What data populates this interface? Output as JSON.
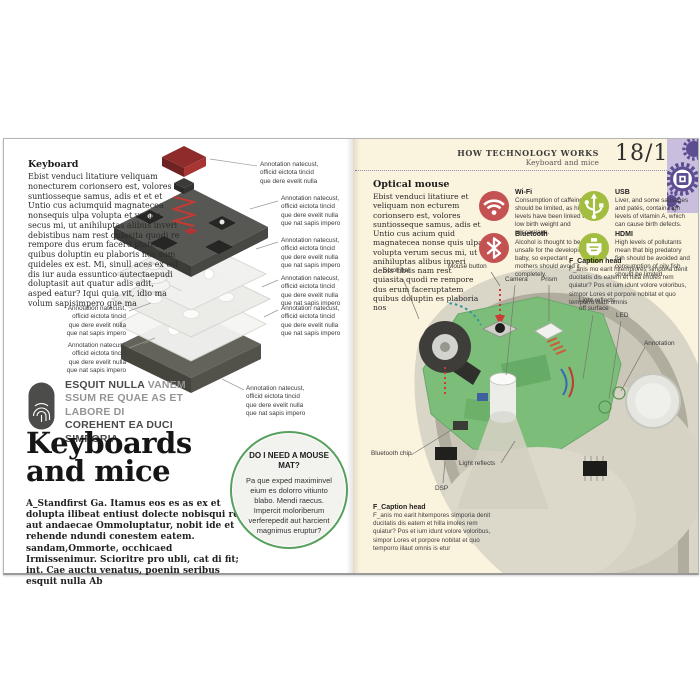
{
  "colors": {
    "right_page_bg": "#faf3dd",
    "feature_red": "#c45252",
    "feature_green": "#a2bd3f",
    "qa_circle_green": "#57a05e",
    "badge_purple": "#5d4d91",
    "badge_bg": "#c9bede",
    "pcb_green": "#7cbe79",
    "arrow_red": "#cc3b35",
    "arrow_teal": "#2e98a0"
  },
  "header": {
    "series": "HOW TECHNOLOGY WORKS",
    "chapter": "Keyboard and mice",
    "pages": "18/19",
    "badge_icon": "gears-chip-icon"
  },
  "left": {
    "intro": {
      "heading": "Keyboard",
      "body": "Ebist venduci litatiure veliquam nonecturem corionsero est, volores suntiosseque samus, adis et et et Untio cus aciumquid magnatecea nonsequis ulpa volupta et verum secus mi, ut anihiluptas alibus inveri debistibus nam rest quiasita quodi re rempore dus erum faceru ptatem quibus doluptin eu plaboris nos sum quideles ex est. Mi, sinull aces ex est dis iur auda essuntico autectaepudi doluptasit aut quatur adis adit, asped eatur? Iqui quia vit, idio ma volum sapisimpero que ma"
    },
    "annotations_right": [
      {
        "text": "Annotation natecust, officid eictota tincid que dere evelit nulla"
      },
      {
        "text": "Annotation natecust, officid eictota tincid que dere evelit nulla que nat sapis impero"
      },
      {
        "text": "Annotation natecust, officid eictota tincid que dere evelit nulla que nat sapis impero"
      },
      {
        "text": "Annotation natecust, officid eictota tincid que dere evelit nulla que nat sapis impero"
      },
      {
        "text": "Annotation natecust, officid eictota tincid que dere evelit nulla que nat sapis impero"
      },
      {
        "text": "Annotation natecust, officid eictota tincid que dere evelit nulla que nat sapis impero"
      }
    ],
    "annotations_left": [
      {
        "text": "Annotation natecust, officid eictota tincid que dere evelit nulla que nat sapis impero"
      },
      {
        "text": "Annotation natecust, officid eictota tincid que dere evelit nulla que nat sapis impero"
      }
    ],
    "quote": {
      "icon": "fingerprint-icon",
      "lead_bold": "ESQUIT NULLA",
      "mid": " VANEM SSUM RE QUAE AS ET LABORE DI ",
      "tail_bold": "COREHENT EA DUCI SIMPORIA"
    },
    "title": "Keyboards and mice",
    "standfirst": "A_Standfirst Ga. Itamus eos es as ex et dolupta ilibeat entiust dolecte nobisqui re, aut andaecae Ommoluptatur, nobit ide et rehende ndundi conestem eatem. sandam,Ommorte, occhicaed Irmissenimur. Scioritre pro ubli, cat di fit; int. Cae auctu venatus, poenin seribus esquit nulla Ab",
    "qa_circle": {
      "heading": "DO I NEED A MOUSE MAT?",
      "body": "Pa que exped maximinvel eium es dolorro vitiunto blabo. Mendi raecus. Impercit moloriberum verferepedit aut harcient magnimus eruptur?"
    }
  },
  "right": {
    "intro": {
      "heading": "Optical mouse",
      "body": "Ebist venduci litatiure et veliquam non ecturem corionsero est, volores suntiosseque samus, adis et Untio cus acium quid magnatecea nonse quis ulpa volupta verum secus mi, ut anihiluptas alibus inveri debis tibus nam rest quiasita quodi re rempore dus erum faceruptatem quibus doluptin es plaboria nos"
    },
    "features": [
      {
        "label": "Wi-Fi",
        "icon": "wifi-icon",
        "color": "#c45252",
        "body": "Consumption of caffeine should be limited, as high levels have been linked to low birth weight and miscarriage."
      },
      {
        "label": "Bluetooth",
        "icon": "bluetooth-icon",
        "color": "#c45252",
        "body": "Alcohol is thought to be unsafe for the developing baby, so expectant mothers should avoid it completely."
      },
      {
        "label": "USB",
        "icon": "usb-icon",
        "color": "#a2bd3f",
        "body": "Liver, and some sausages and patés, contain high levels of vitamin A, which can cause birth defects."
      },
      {
        "label": "HDMI",
        "icon": "hdmi-icon",
        "color": "#a2bd3f",
        "body": "High levels of pollutants mean that big predatory fish should be avoided and consumption of oily fish should be limited."
      }
    ],
    "caption_top": {
      "heading": "F_Caption head",
      "body": "F_anis mo earit hitempiores simporia denit ducitatis dis eatem et hilla imoles rem quiatur? Pos et ium idunt volore voloribus, simpor Lores et porpore nobitat et quo temporro illaut omnis"
    },
    "caption_bottom": {
      "heading": "F_Caption head",
      "body": "F_anis mo earit hitempores simporia denit ducitatis dis eatem et hilla imoles rem quiatur? Pos et ium idunt volore voloribus, simpor Lores et porpore nobitat et quo temporro illaut omnis is etur"
    },
    "labels": {
      "scroll_ball": "Scroll ball",
      "mouse_button": "Mouse button",
      "camera": "Camera",
      "prism": "Prism",
      "light_surface": "Light reflects off surface",
      "led": "LED",
      "annotation": "Annotation",
      "bluetooth_chip": "Bluetooth chip",
      "light_reflects": "Light reflects",
      "dsp": "DSP"
    }
  }
}
